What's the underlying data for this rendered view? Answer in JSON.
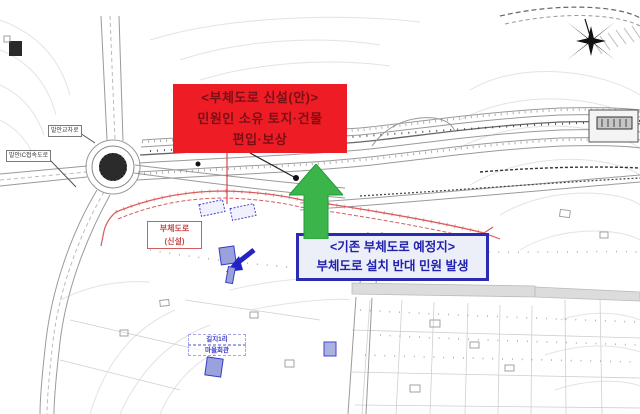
{
  "title": "부체도로 계획 평면도",
  "colors": {
    "red_box_bg": "#ee1c24",
    "red_box_text": "#7a1016",
    "blue_box_bg": "#eceef8",
    "blue_box_border": "#2b2bb2",
    "blue_box_text": "#2222ae",
    "green_arrow": "#3bb54a",
    "green_arrow_edge": "#1f9c3c"
  },
  "callouts": {
    "new_road": {
      "lines": [
        "<부체도로 신설(안)>",
        "민원인 소유 토지·건물",
        "편입·보상"
      ]
    },
    "existing_road": {
      "lines": [
        "<기존 부체도로 예정지>",
        "부체도로 설치 반대 민원 발생"
      ]
    }
  },
  "map_labels": {
    "new_road_tag": {
      "line1": "부체도로",
      "line2": "(신설)"
    },
    "junction": "발안교차로",
    "access_road": "발안IC접속도로",
    "village_hall": {
      "line1": "길지1리",
      "line2": "마을회관"
    }
  }
}
